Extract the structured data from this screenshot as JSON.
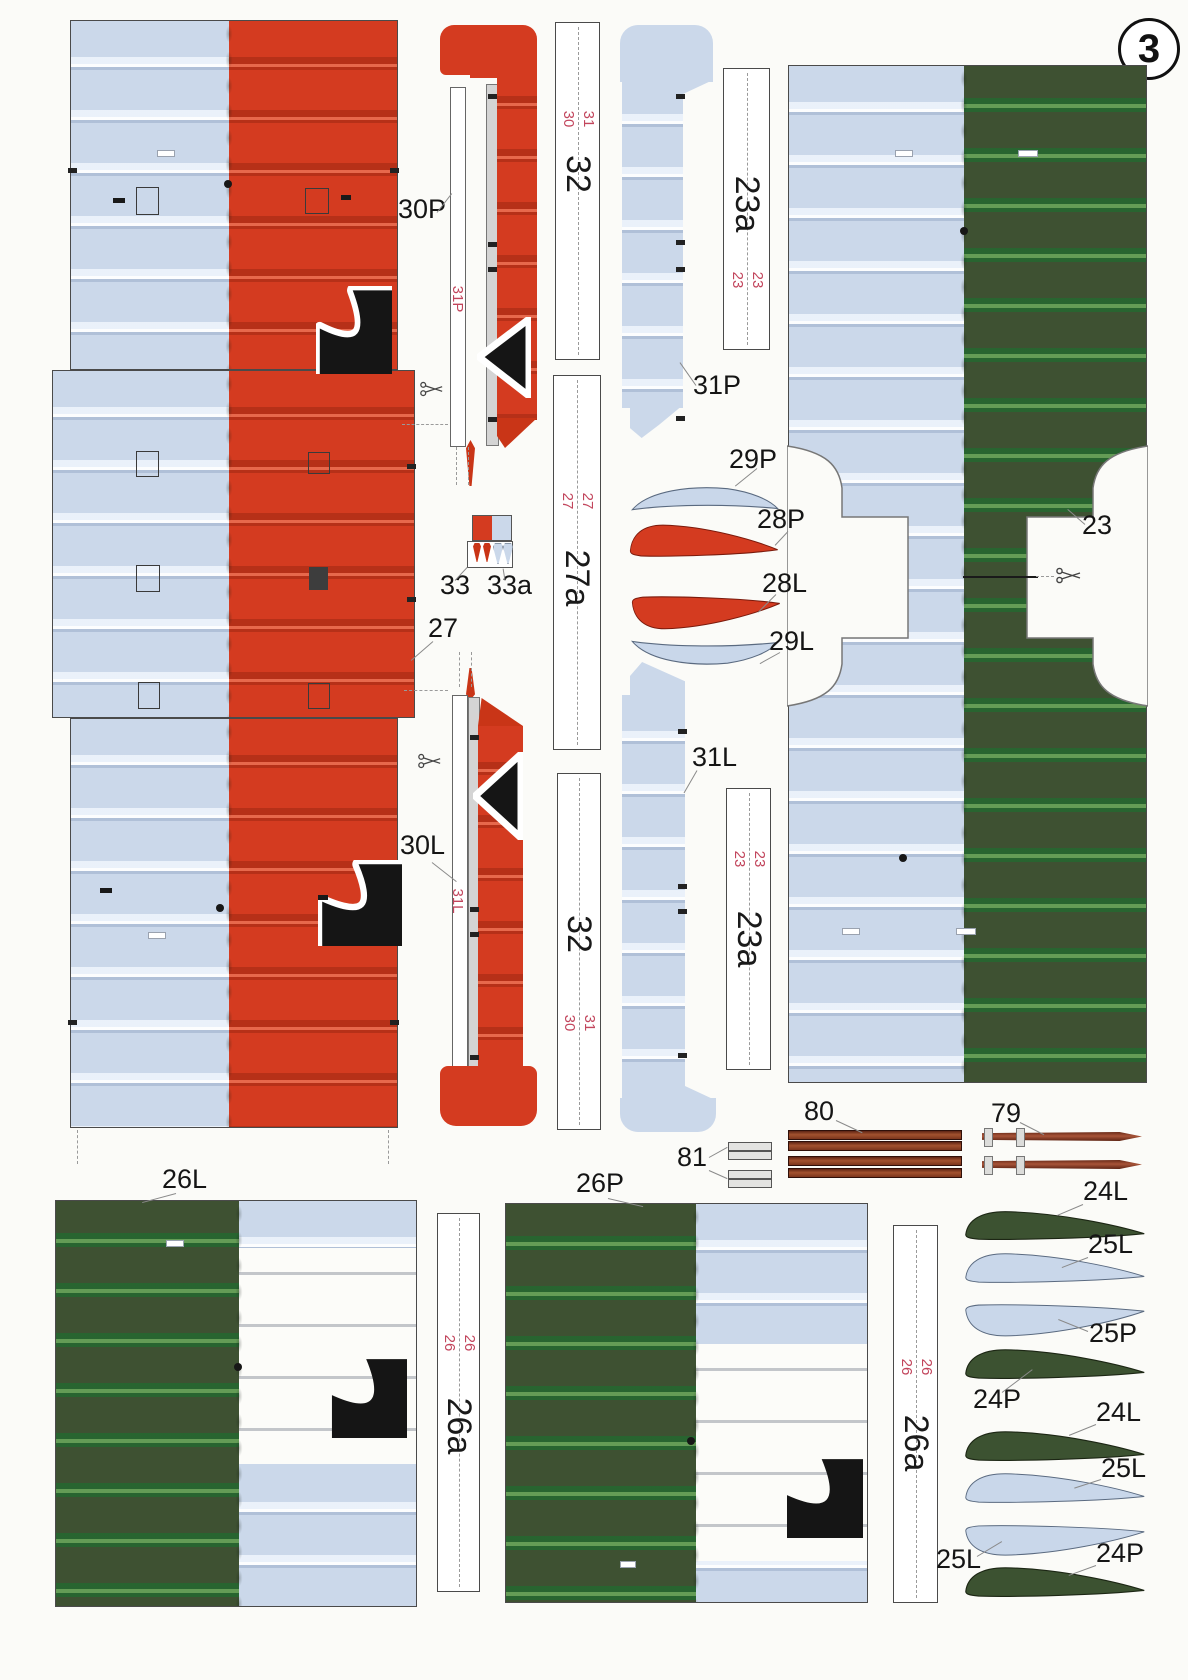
{
  "sheet": {
    "number": "3"
  },
  "colors": {
    "red": "#d43b20",
    "light_blue": "#cbd8ea",
    "dark_green": "#3e5132",
    "wood_brown": "#96492f",
    "code_red": "#c2455c"
  },
  "labels": {
    "wing27": "27",
    "p30P": "30P",
    "p30P_edge": "31P",
    "p31P": "31P",
    "strip32_top": {
      "title": "32",
      "left": "30",
      "right": "31"
    },
    "strip23a_top": {
      "title": "23a",
      "left": "23",
      "right": "23"
    },
    "p23": "23",
    "strip27a": {
      "title": "27a",
      "left": "27",
      "right": "27"
    },
    "p33": "33",
    "p33a": "33a",
    "p29P": "29P",
    "p28P": "28P",
    "p28L": "28L",
    "p29L": "29L",
    "p30L": "30L",
    "p30L_edge": "31L",
    "p31L": "31L",
    "strip32_bottom": {
      "title": "32",
      "left": "30",
      "right": "31"
    },
    "strip23a_bottom": {
      "title": "23a",
      "left": "23",
      "right": "23"
    },
    "p80": "80",
    "p79": "79",
    "p81": "81",
    "w26L": "26L",
    "w26P": "26P",
    "strip26a_left": {
      "title": "26a",
      "left": "26",
      "right": "26"
    },
    "strip26a_right": {
      "title": "26a",
      "left": "26",
      "right": "26"
    }
  },
  "blades": [
    {
      "label": "24L"
    },
    {
      "label": "25L"
    },
    {
      "label": "25P"
    },
    {
      "label": "24P"
    },
    {
      "label": "24L"
    },
    {
      "label": "25L"
    },
    {
      "label": "25L"
    },
    {
      "label": "24P"
    }
  ]
}
